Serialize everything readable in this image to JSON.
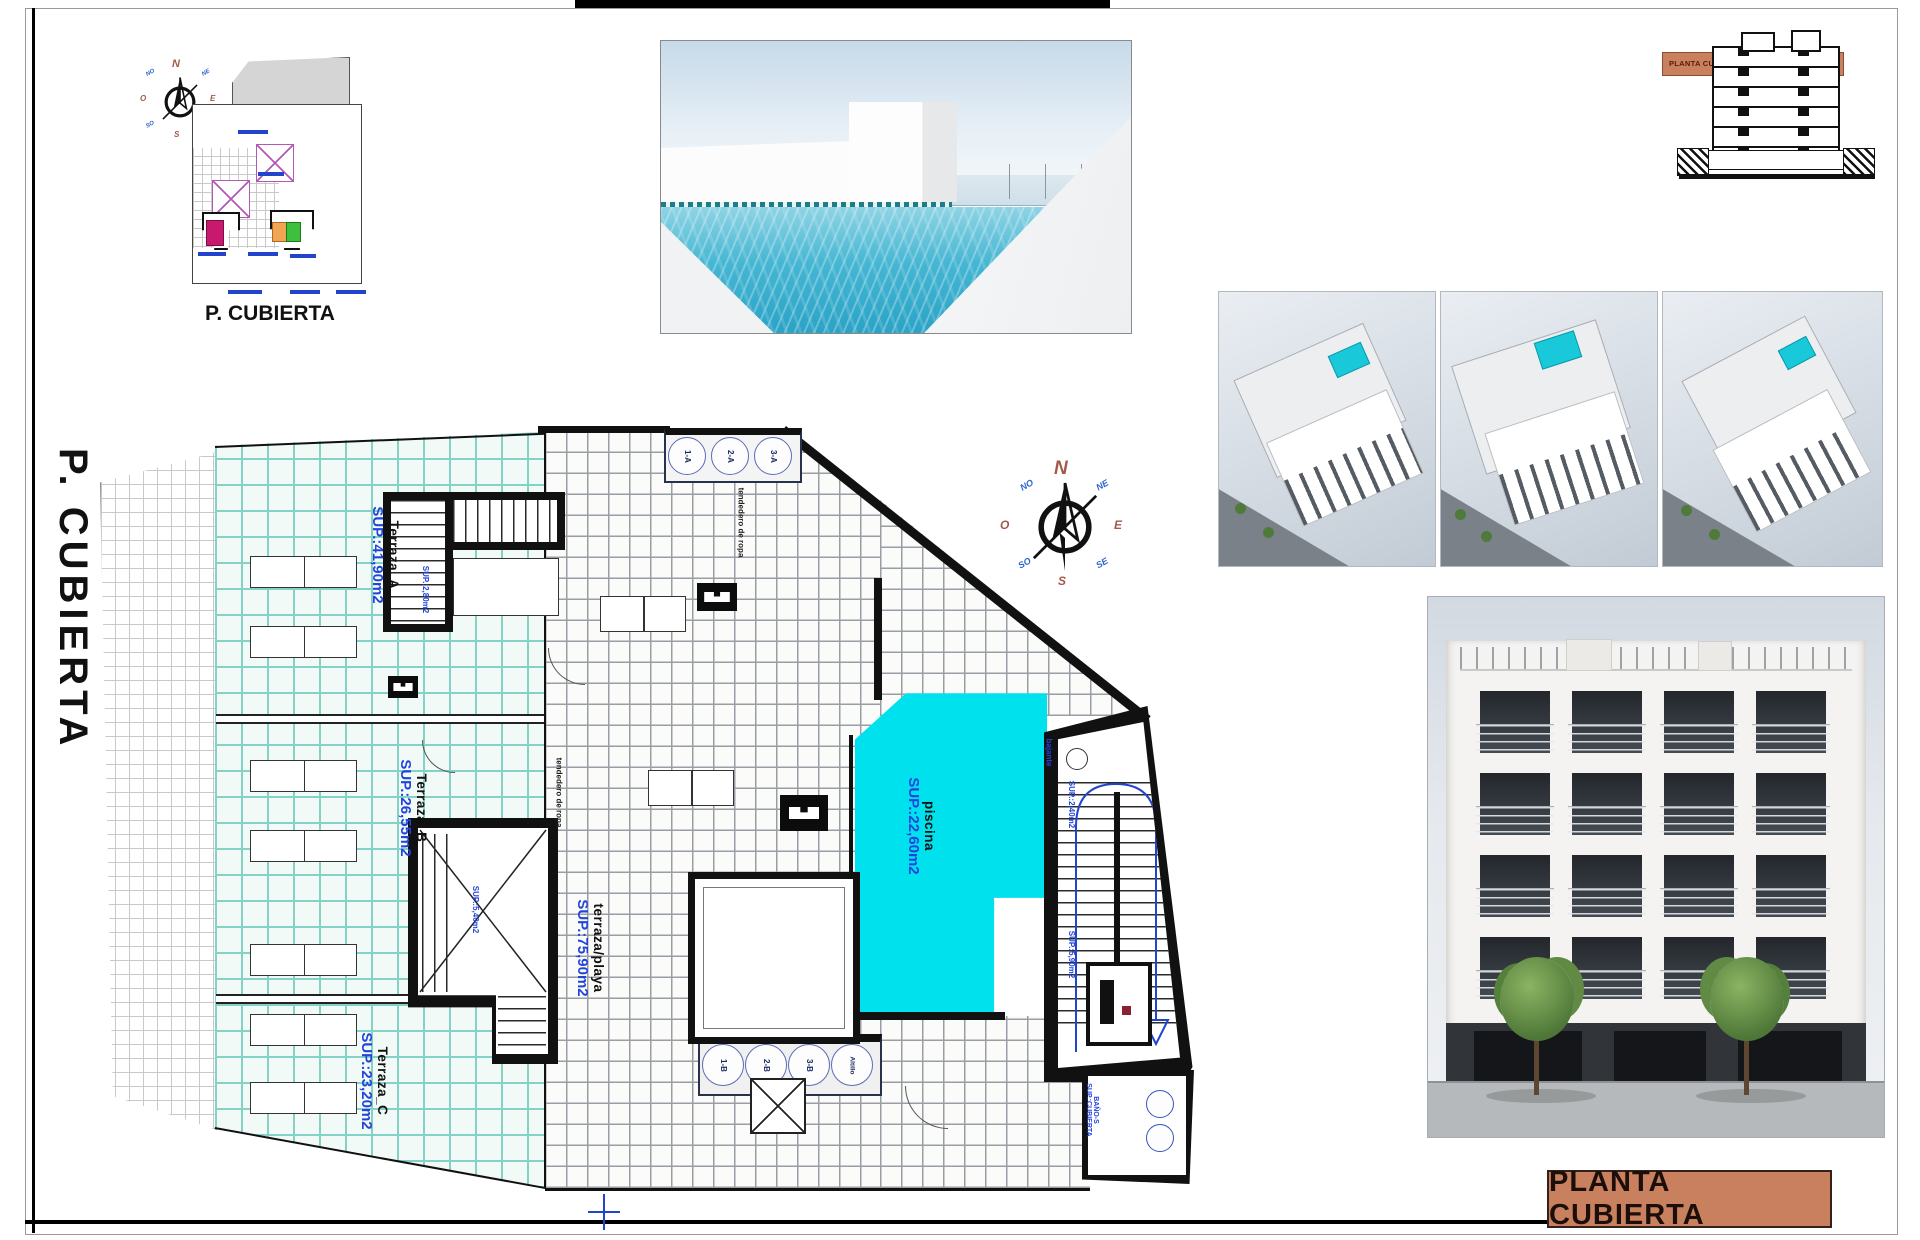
{
  "sheet": {
    "side_title": "P. CUBIERTA",
    "title_block": "PLANTA CUBIERTA",
    "section_band": "PLANTA CUBIERTA",
    "site_caption": "P. CUBIERTA",
    "accent_color": "#c8805f",
    "pool_color": "#00e1ee",
    "label_blue": "#2244dd"
  },
  "compass": {
    "n": "N",
    "e": "E",
    "s": "S",
    "o": "O",
    "no": "NO",
    "ne": "NE",
    "so": "SO",
    "se": "SE"
  },
  "plan": {
    "terrace_a": {
      "name": "Terraza_A",
      "sup": "SUP.:41,90m2"
    },
    "terrace_b": {
      "name": "Terraza_B",
      "sup": "SUP.:26,55m2"
    },
    "terrace_c": {
      "name": "Terraza_C",
      "sup": "SUP.:23,20m2"
    },
    "beach_terrace": {
      "name": "terraza/playa",
      "sup": "SUP.:75,90m2"
    },
    "pool": {
      "name": "piscina",
      "sup": "SUP.:22,60m2"
    },
    "skylights_top": [
      "1-A",
      "2-A",
      "3-A"
    ],
    "skylights_bottom": [
      "1-B",
      "2-B",
      "3-B",
      "Altillo"
    ],
    "stairA_sup": "SUP.:2,80m2",
    "stairB_sup": "SUP.:5,40m2",
    "stair_main_sup_top": "SUP.:2,40m2",
    "stair_main_sup": "SUP.:5,90m2",
    "drain": "bajante",
    "laundry": "tendedero de ropa",
    "bath": {
      "name": "BAÑO-S",
      "sup": "SUP.:CUBIERTA"
    }
  }
}
